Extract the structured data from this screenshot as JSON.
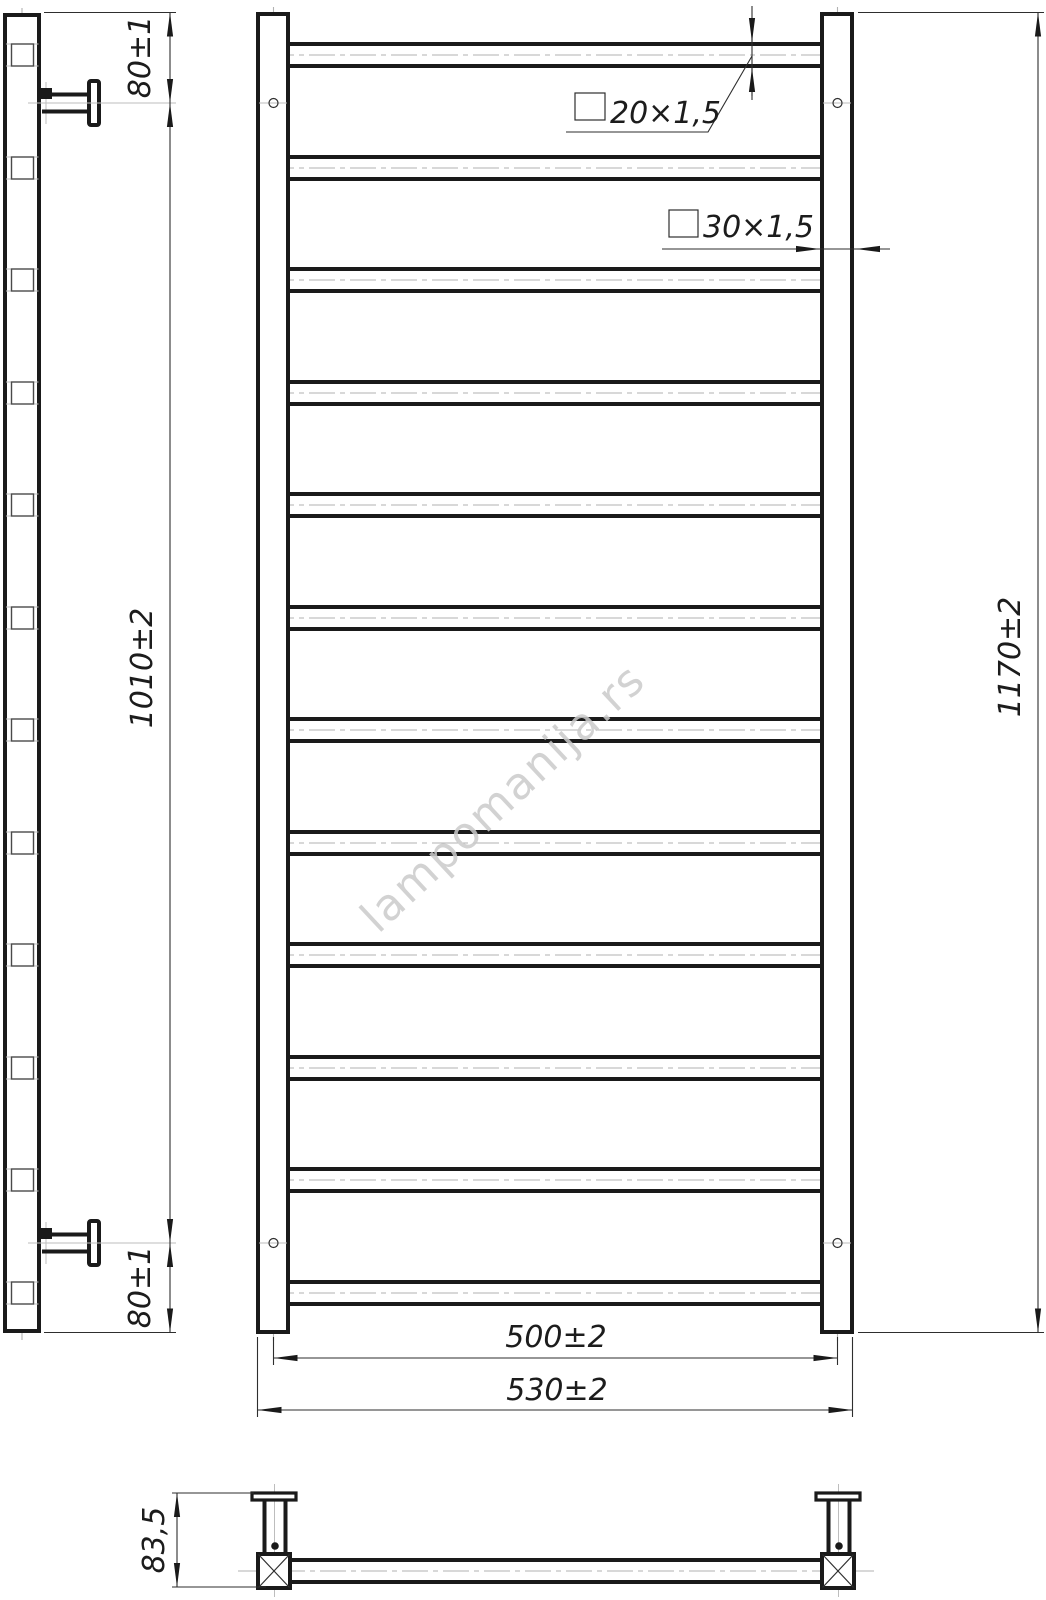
{
  "drawing": {
    "watermark": "lampomanija.rs",
    "rung_count": 12,
    "rung_centers_px": [
      55,
      168,
      280,
      393,
      505,
      618,
      730,
      843,
      955,
      1068,
      1180,
      1293
    ],
    "labels": {
      "dim_top_offset": "80±1",
      "dim_bracket_span": "1010±2",
      "dim_bottom_offset": "80±1",
      "dim_overall_height": "1170±2",
      "dim_center_width": "500±2",
      "dim_overall_width": "530±2",
      "dim_bracket_depth": "83,5",
      "rung_tube_section": "20×1,5",
      "post_tube_section": "30×1,5"
    },
    "colors": {
      "line": "#1a1a1a",
      "thin_line": "#2e2e2e",
      "centerline": "#b2b2b2",
      "watermark": "#cbcbcb"
    }
  }
}
